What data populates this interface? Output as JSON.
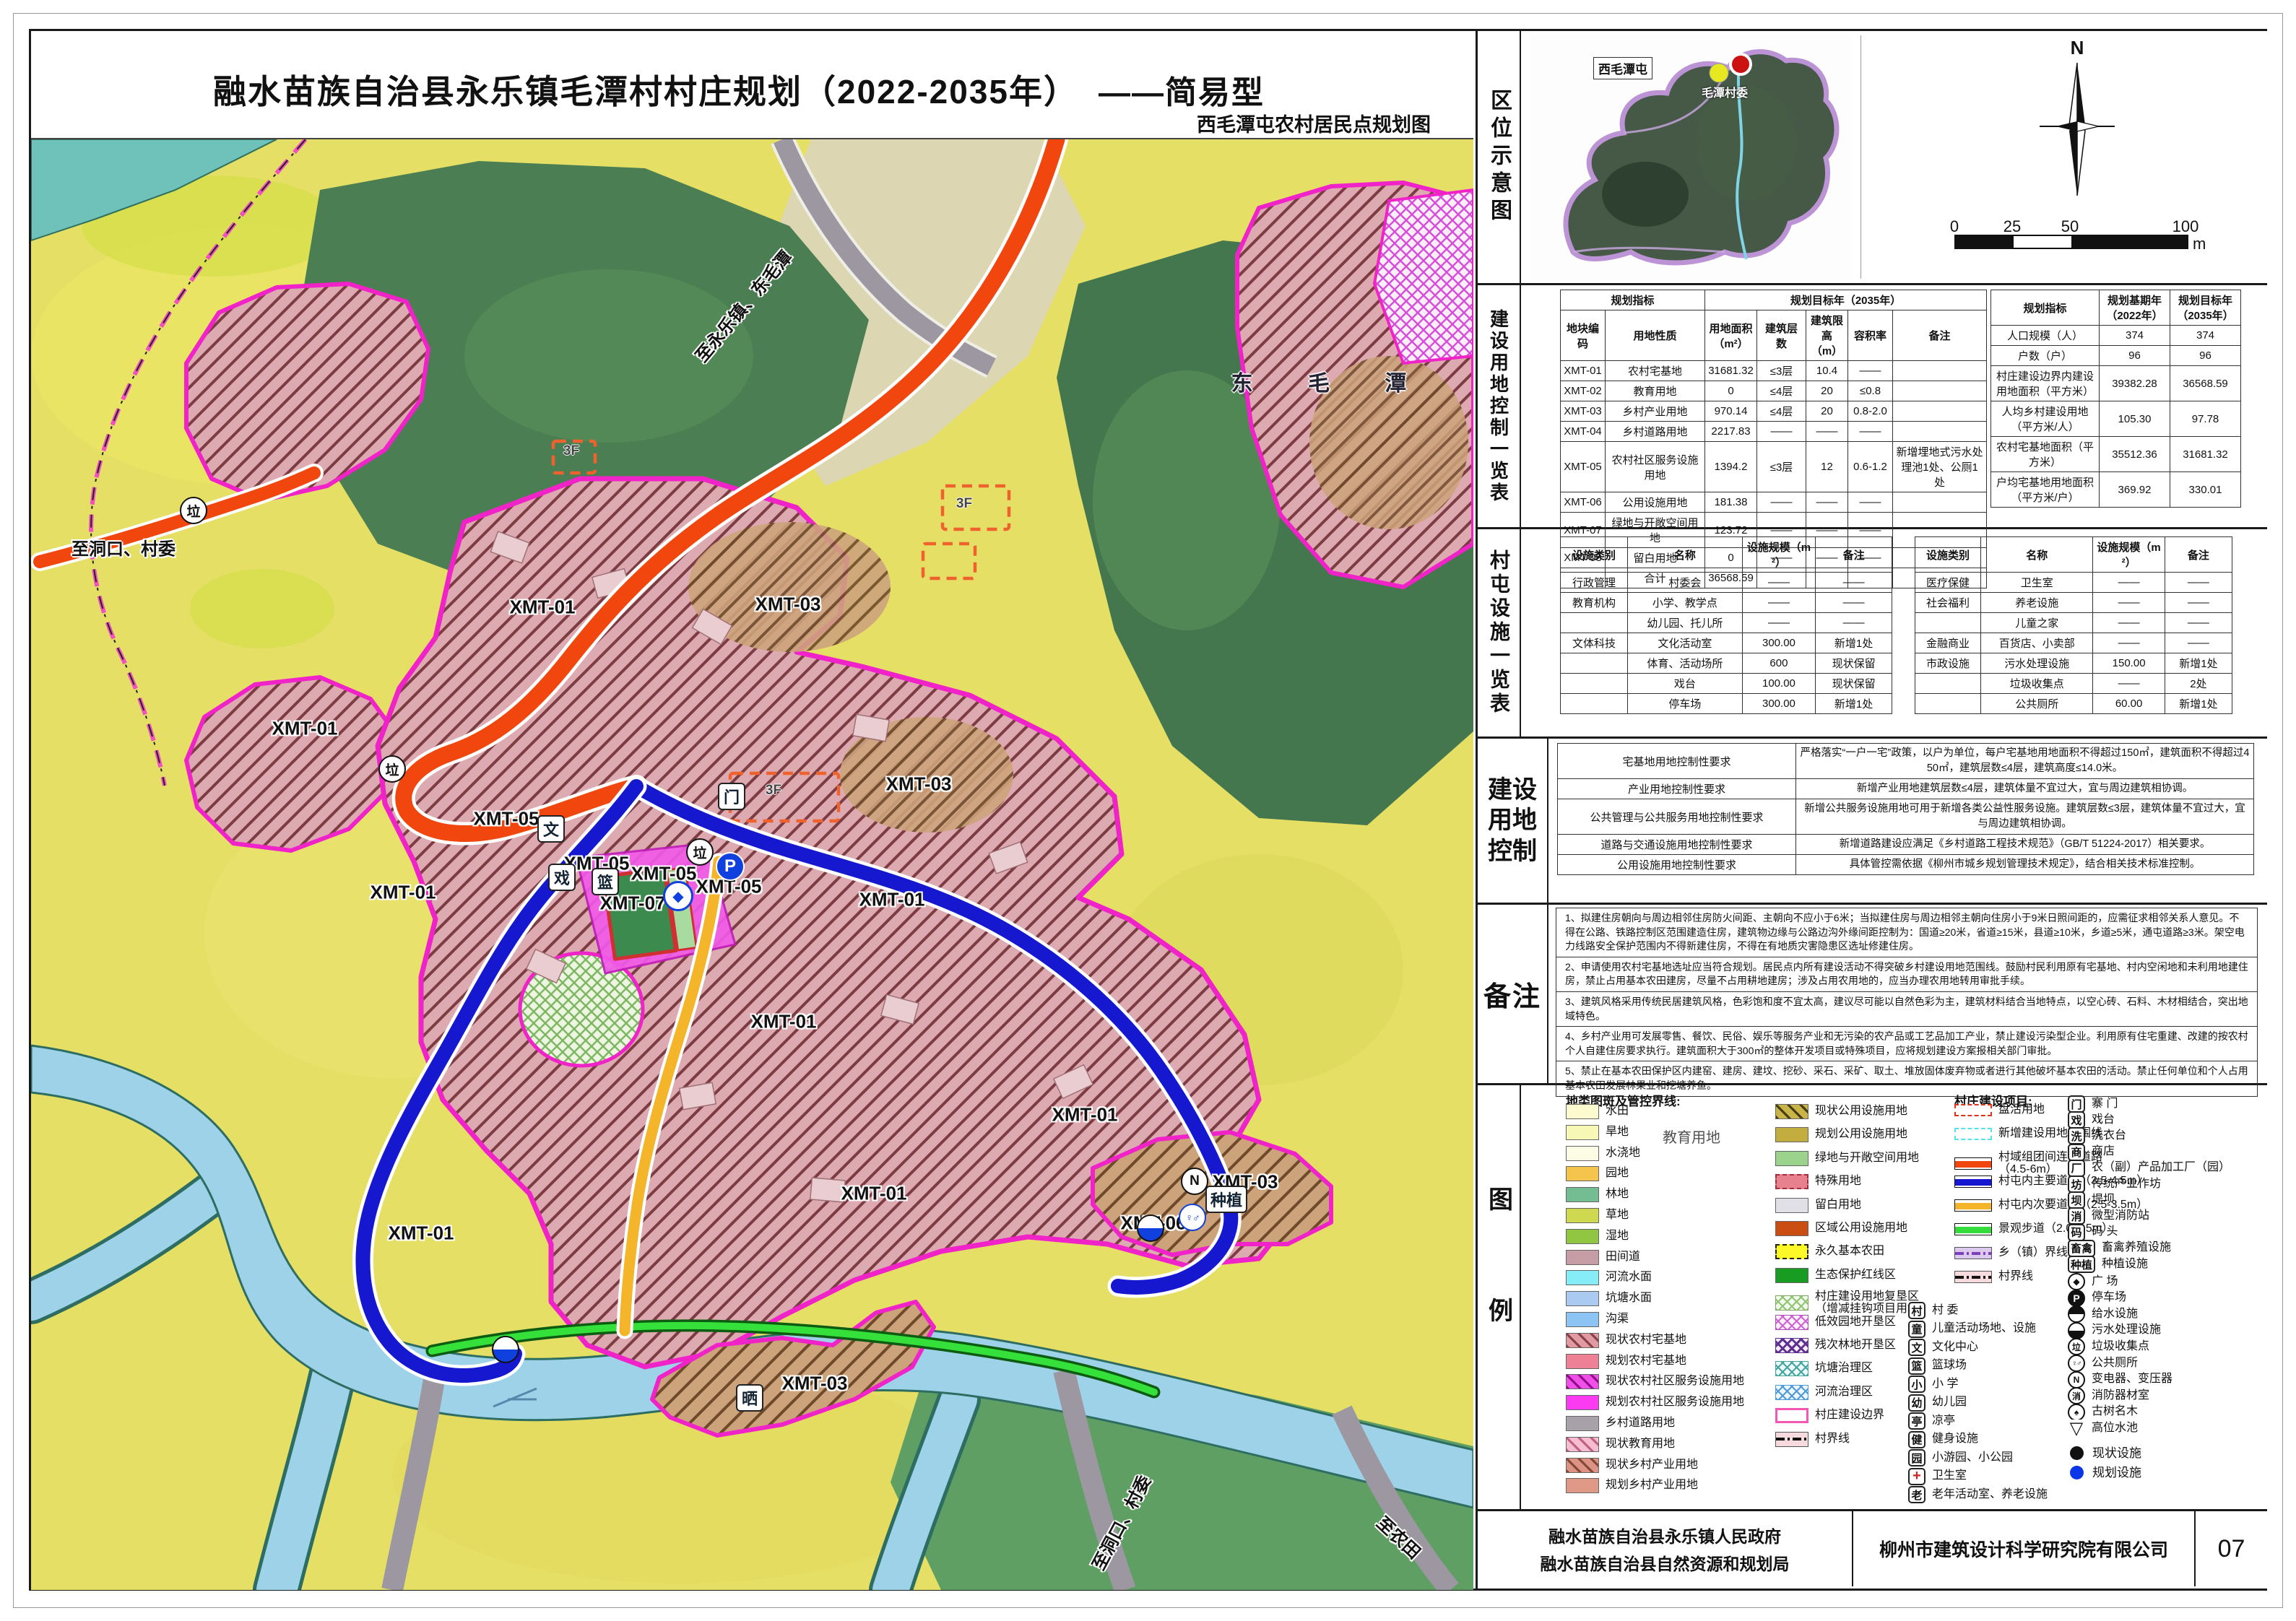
{
  "title": "融水苗族自治县永乐镇毛潭村村庄规划（2022-2035年）",
  "title_suffix": "——简易型",
  "subtitle": "西毛潭屯农村居民点规划图",
  "location": {
    "label": "区位示意图",
    "place_highlight": "西毛潭屯",
    "place_committee": "毛潭村委",
    "north": "N",
    "scale_ticks": [
      "0",
      "25",
      "50",
      "100"
    ],
    "scale_unit": "m"
  },
  "land_table": {
    "label": "建设用地控制一览表",
    "h_plan": "规划指标",
    "h_target": "规划目标年（2035年）",
    "h_code": "地块编码",
    "h_nature": "用地性质",
    "h_area": "用地面积（m²）",
    "h_floors": "建筑层数",
    "h_height": "建筑限高（m）",
    "h_far": "容积率",
    "h_remark": "备注",
    "rows": [
      [
        "XMT-01",
        "农村宅基地",
        "31681.32",
        "≤3层",
        "10.4",
        "——",
        ""
      ],
      [
        "XMT-02",
        "教育用地",
        "0",
        "≤4层",
        "20",
        "≤0.8",
        ""
      ],
      [
        "XMT-03",
        "乡村产业用地",
        "970.14",
        "≤4层",
        "20",
        "0.8-2.0",
        ""
      ],
      [
        "XMT-04",
        "乡村道路用地",
        "2217.83",
        "——",
        "——",
        "——",
        ""
      ],
      [
        "XMT-05",
        "农村社区服务设施用地",
        "1394.2",
        "≤3层",
        "12",
        "0.6-1.2",
        "新增埋地式污水处理池1处、公厕1处"
      ],
      [
        "XMT-06",
        "公用设施用地",
        "181.38",
        "——",
        "——",
        "——",
        ""
      ],
      [
        "XMT-07",
        "绿地与开敞空间用地",
        "123.72",
        "——",
        "——",
        "——",
        ""
      ],
      [
        "XMT-08",
        "留白用地",
        "0",
        "——",
        "——",
        "——",
        ""
      ],
      [
        "",
        "合计",
        "36568.59",
        "",
        "",
        "",
        ""
      ]
    ],
    "ind_h_idx": "规划指标",
    "ind_h_base": "规划基期年（2022年）",
    "ind_h_target": "规划目标年（2035年）",
    "ind_rows": [
      [
        "人口规模（人）",
        "374",
        "374"
      ],
      [
        "户数（户）",
        "96",
        "96"
      ],
      [
        "村庄建设边界内建设用地面积（平方米）",
        "39382.28",
        "36568.59"
      ],
      [
        "人均乡村建设用地（平方米/人）",
        "105.30",
        "97.78"
      ],
      [
        "农村宅基地面积（平方米）",
        "35512.36",
        "31681.32"
      ],
      [
        "户均宅基地用地面积（平方米/户）",
        "369.92",
        "330.01"
      ]
    ]
  },
  "facility_table": {
    "label": "村屯设施一览表",
    "h_cat": "设施类别",
    "h_name": "名称",
    "h_scale": "设施规模（m²）",
    "h_remark": "备注",
    "left_rows": [
      [
        "行政管理",
        "村委会",
        "——",
        "——"
      ],
      [
        "教育机构",
        "小学、教学点",
        "——",
        "——"
      ],
      [
        "",
        "幼儿园、托儿所",
        "——",
        "——"
      ],
      [
        "文体科技",
        "文化活动室",
        "300.00",
        "新增1处"
      ],
      [
        "",
        "体育、活动场所",
        "600",
        "现状保留"
      ],
      [
        "",
        "戏台",
        "100.00",
        "现状保留"
      ],
      [
        "",
        "停车场",
        "300.00",
        "新增1处"
      ]
    ],
    "right_rows": [
      [
        "医疗保健",
        "卫生室",
        "——",
        "——"
      ],
      [
        "社会福利",
        "养老设施",
        "——",
        "——"
      ],
      [
        "",
        "儿童之家",
        "——",
        "——"
      ],
      [
        "金融商业",
        "百货店、小卖部",
        "——",
        "——"
      ],
      [
        "市政设施",
        "污水处理设施",
        "150.00",
        "新增1处"
      ],
      [
        "",
        "垃圾收集点",
        "——",
        "2处"
      ],
      [
        "",
        "公共厕所",
        "60.00",
        "新增1处"
      ]
    ]
  },
  "control": {
    "label": "建设用地控制",
    "rows": [
      {
        "t": "宅基地用地控制性要求",
        "d": "严格落实“一户一宅”政策，以户为单位，每户宅基地用地面积不得超过150㎡，建筑面积不得超过450㎡，建筑层数≤4层，建筑高度≤14.0米。"
      },
      {
        "t": "产业用地控制性要求",
        "d": "新增产业用地建筑层数≤4层，建筑体量不宜过大，宜与周边建筑相协调。"
      },
      {
        "t": "公共管理与公共服务用地控制性要求",
        "d": "新增公共服务设施用地可用于新增各类公益性服务设施。建筑层数≤3层，建筑体量不宜过大，宜与周边建筑相协调。"
      },
      {
        "t": "道路与交通设施用地控制性要求",
        "d": "新增道路建设应满足《乡村道路工程技术规范》（GB/T 51224-2017）相关要求。"
      },
      {
        "t": "公用设施用地控制性要求",
        "d": "具体管控需依据《柳州市城乡规划管理技术规定》，结合相关技术标准控制。"
      }
    ]
  },
  "notes": {
    "label": "备注",
    "items": [
      "1、拟建住房朝向与周边相邻住房防火间距、主朝向不应小于6米；当拟建住房与周边相邻主朝向住房小于9米日照间距的，应需征求相邻关系人意见。不得在公路、铁路控制区范围建造住房，建筑物边缘与公路边沟外缘间距控制为：国道≥20米，省道≥15米，县道≥10米，乡道≥5米，通屯道路≥3米。架空电力线路安全保护范围内不得新建住房，不得在有地质灾害隐患区选址修建住房。",
      "2、申请使用农村宅基地选址应当符合规划。居民点内所有建设活动不得突破乡村建设用地范围线。鼓励村民利用原有宅基地、村内空闲地和未利用地建住房，禁止占用基本农田建房，尽量不占用耕地建房；涉及占用农用地的，应当办理农用地转用审批手续。",
      "3、建筑风格采用传统民居建筑风格，色彩饱和度不宜太高，建议尽可能以自然色彩为主，建筑材料结合当地特点，以空心砖、石料、木材相结合，突出地域特色。",
      "4、乡村产业用可发展零售、餐饮、民俗、娱乐等服务产业和无污染的农产品或工艺品加工产业，禁止建设污染型企业。利用原有住宅重建、改建的按农村个人自建住房要求执行。建筑面积大于300㎡的整体开发项目或特殊项目，应将规划建设方案报相关部门审批。",
      "5、禁止在基本农田保护区内建窑、建房、建坟、挖砂、采石、采矿、取土、堆放固体废弃物或者进行其他破坏基本农田的活动。禁止任何单位和个人占用基本农田发展林果业和挖塘养鱼。"
    ]
  },
  "legend": {
    "label": "图例",
    "group1_title": "地类图斑及管控界线:",
    "group2_title": "村庄建设项目:",
    "stray_label": "教育用地",
    "col1": [
      {
        "t": "水田",
        "sw": "background:#fbfbcf"
      },
      {
        "t": "旱地",
        "sw": "background:#f8f8b6"
      },
      {
        "t": "水浇地",
        "sw": "background:#fdfce4"
      },
      {
        "t": "园地",
        "sw": "background:#f4c44c"
      },
      {
        "t": "林地",
        "sw": "background:#74bd92"
      },
      {
        "t": "草地",
        "sw": "background:#ced94f"
      },
      {
        "t": "湿地",
        "sw": "background:#90c641"
      },
      {
        "t": "田间道",
        "sw": "background:#c69da5"
      },
      {
        "t": "河流水面",
        "sw": "background:#86ecf8"
      },
      {
        "t": "坑塘水面",
        "sw": "background:#abcaf1"
      },
      {
        "t": "沟渠",
        "sw": "background:#8cc5f3"
      },
      {
        "t": "现状农村宅基地",
        "sw": "background:repeating-linear-gradient(45deg,#8a4048 0 3px,#e19aa2 3px 12px)"
      },
      {
        "t": "规划农村宅基地",
        "sw": "background:#ee8195"
      },
      {
        "t": "现状农村社区服务设施用地",
        "sw": "background:repeating-linear-gradient(45deg,#930d8a 0 3px,#f14fe9 3px 12px)"
      },
      {
        "t": "规划农村社区服务设施用地",
        "sw": "background:#fa3bf2"
      },
      {
        "t": "乡村道路用地",
        "sw": "background:#a8a1a9"
      },
      {
        "t": "现状教育用地",
        "sw": "background:repeating-linear-gradient(45deg,#c2607f 0 3px,#f6bccf 3px 12px)"
      },
      {
        "t": "现状乡村产业用地",
        "sw": "background:repeating-linear-gradient(45deg,#84473a 0 3px,#dc9384 3px 12px)"
      },
      {
        "t": "规划乡村产业用地",
        "sw": "background:#e19987"
      }
    ],
    "col2": [
      {
        "t": "现状公用设施用地",
        "sw": "background:repeating-linear-gradient(45deg,#453e12 0 3px,#c9b449 3px 12px)"
      },
      {
        "t": "规划公用设施用地",
        "sw": "background:#c3ad3f"
      },
      {
        "t": "绿地与开敞空间用地",
        "sw": "background:#9bd38d"
      },
      {
        "t": "特殊用地",
        "sw": "background:#e8818e;border:2px dashed #a03040"
      },
      {
        "t": "留白用地",
        "sw": "background:#e1e0e7"
      },
      {
        "t": "区域公用设施用地",
        "sw": "background:#ca4e11"
      },
      {
        "t": "永久基本农田",
        "sw": "background:#fdf827;border:2px dashed #222"
      },
      {
        "t": "生态保护红线区",
        "sw": "background:#189c21"
      },
      {
        "t": "村庄建设用地复垦区\n（增减挂钩项目用地）",
        "sw": "background:repeating-linear-gradient(45deg,#8fc473 0 2px,transparent 2px 9px),repeating-linear-gradient(-45deg,#8fc473 0 2px,transparent 2px 9px),#f4faee;border:1px solid #7aa860"
      },
      {
        "t": "低效园地开垦区",
        "sw": "background:repeating-linear-gradient(45deg,#cf63d4 0 2px,transparent 2px 9px),repeating-linear-gradient(-45deg,#cf63d4 0 2px,transparent 2px 9px),#fdf2fe;border:1px solid #b050b8"
      },
      {
        "t": "残次林地开垦区",
        "sw": "background:repeating-linear-gradient(45deg,#5f2f90 0 3px,transparent 3px 9px),repeating-linear-gradient(-45deg,#5f2f90 0 3px,transparent 3px 9px),#f3ecfa;border:1px solid #5f2f90"
      },
      {
        "t": "坑塘治理区",
        "sw": "background:repeating-linear-gradient(45deg,#44a5a0 0 2px,transparent 2px 9px),repeating-linear-gradient(-45deg,#44a5a0 0 2px,transparent 2px 9px),#eefafa;border:1px solid #44a5a0"
      },
      {
        "t": "河流治理区",
        "sw": "background:repeating-linear-gradient(45deg,#4f9ad9 0 2px,transparent 2px 9px),repeating-linear-gradient(-45deg,#4f9ad9 0 2px,transparent 2px 9px),#eef6fe;border:1px solid #4f9ad9"
      },
      {
        "t": "村庄建设边界",
        "sw": "background:#fff;border:3px solid #f357b5"
      },
      {
        "t": "村界线",
        "sw": "background:repeating-linear-gradient(90deg,#111 0 12px,transparent 12px 16px,#111 16px 19px,transparent 19px 23px) center/100% 4px no-repeat,#f6dade;border:1px solid #555"
      }
    ],
    "col3": [
      {
        "t": "盘活用地",
        "sw": "background:#fff;border:2px dashed #dd3418"
      },
      {
        "t": "新增建设用地范围线",
        "sw": "background:#fff;border:2px dashed #55e2ee"
      },
      {
        "t": "村域组团间连接道路\n（4.5-6m）",
        "sw": "background:linear-gradient(#fff 0 4px,#f1470f 4px 13px,#fff 13px 17px);border:1.5px solid #111"
      },
      {
        "t": "村屯内主要道路（3.5-4.5m）",
        "sw": "background:linear-gradient(#fff 0 4px,#1518cf 4px 13px,#fff 13px 17px);border:1.5px solid #111"
      },
      {
        "t": "村屯内次要道路（2.5-3.5m）",
        "sw": "background:linear-gradient(#fff 0 4px,#f5b52b 4px 13px,#fff 13px 17px);border:1.5px solid #111"
      },
      {
        "t": "景观步道（2.0-2.5m）",
        "sw": "background:linear-gradient(#fff 0 4px,#35dd3c 4px 13px,#fff 13px 17px);border:1.5px solid #111"
      },
      {
        "t": "乡（镇）界线",
        "sw": "background:repeating-linear-gradient(90deg,#7b3fc0 0 12px,transparent 12px 16px,#7b3fc0 16px 19px,transparent 19px 23px) center/100% 4px no-repeat,#dcc9f0;border:1px solid #555"
      },
      {
        "t": "村界线",
        "sw": "background:repeating-linear-gradient(90deg,#111 0 12px,transparent 12px 16px,#111 16px 19px,transparent 19px 23px) center/100% 4px no-repeat,#f6dade;border:1px solid #555"
      }
    ],
    "col3_icons": [
      {
        "g": "村",
        "t": "村  委"
      },
      {
        "g": "童",
        "t": "儿童活动场地、设施"
      },
      {
        "g": "文",
        "t": "文化中心"
      },
      {
        "g": "篮",
        "t": "篮球场"
      },
      {
        "g": "小",
        "t": "小  学"
      },
      {
        "g": "幼",
        "t": "幼儿园"
      },
      {
        "g": "亭",
        "t": "凉亭"
      },
      {
        "g": "健",
        "t": "健身设施"
      },
      {
        "g": "园",
        "t": "小游园、小公园"
      },
      {
        "g": "+",
        "t": "卫生室",
        "cls": "cross"
      },
      {
        "g": "老",
        "t": "老年活动室、养老设施"
      }
    ],
    "col4_icons": [
      {
        "g": "门",
        "t": "寨  门"
      },
      {
        "g": "戏",
        "t": "戏台"
      },
      {
        "g": "洗",
        "t": "洗衣台"
      },
      {
        "g": "商",
        "t": "商店"
      },
      {
        "g": "厂",
        "t": "农（副）产品加工厂（园）"
      },
      {
        "g": "坊",
        "t": "传统产业作坊"
      },
      {
        "g": "坝",
        "t": "堤坝"
      },
      {
        "g": "消",
        "t": "微型消防站"
      },
      {
        "g": "码",
        "t": "码  头"
      },
      {
        "g": "畜禽",
        "t": "畜禽养殖设施"
      },
      {
        "g": "种植",
        "t": "种植设施"
      }
    ],
    "col4_circles": [
      {
        "g": "◆",
        "t": "广  场",
        "cls": "dia"
      },
      {
        "g": "P",
        "t": "停车场",
        "cls": "pd"
      },
      {
        "g": "",
        "t": "给水设施",
        "cls": "ht"
      },
      {
        "g": "",
        "t": "污水处理设施",
        "cls": "hb"
      },
      {
        "g": "垃",
        "t": "垃圾收集点",
        "cls": ""
      },
      {
        "g": "♀♂",
        "t": "公共厕所",
        "cls": "wc"
      },
      {
        "g": "N",
        "t": "变电器、变压器",
        "cls": ""
      },
      {
        "g": "消",
        "t": "消防器材室",
        "cls": ""
      },
      {
        "g": "♠",
        "t": "古树名木",
        "cls": ""
      },
      {
        "g": "▽",
        "t": "高位水池",
        "cls": "tz"
      }
    ],
    "col4_dots": [
      {
        "t": "现状设施",
        "cls": "dotb"
      },
      {
        "t": "规划设施",
        "cls": "dotu"
      }
    ]
  },
  "footer": {
    "org1": "融水苗族自治县永乐镇人民政府",
    "org2": "融水苗族自治县自然资源和规划局",
    "company": "柳州市建筑设计科学研究院有限公司",
    "page": "07"
  },
  "map": {
    "labels": [
      {
        "t": "XMT-01",
        "c": "xl",
        "s": "left:708px;top:648px;transform:translate(-50%,-50%)"
      },
      {
        "t": "XMT-03",
        "c": "xl",
        "s": "left:1048px;top:644px;transform:translate(-50%,-50%)"
      },
      {
        "t": "XMT-01",
        "c": "xl",
        "s": "left:379px;top:816px;transform:translate(-50%,-50%)"
      },
      {
        "t": "XMT-05",
        "c": "xl",
        "s": "left:658px;top:941px;transform:translate(-50%,-50%)"
      },
      {
        "t": "XMT-01",
        "c": "xl",
        "s": "left:515px;top:1043px;transform:translate(-50%,-50%)"
      },
      {
        "t": "XMT-03",
        "c": "xl",
        "s": "left:1229px;top:893px;transform:translate(-50%,-50%)"
      },
      {
        "t": "XMT-05",
        "c": "xl",
        "s": "left:783px;top:1003px;transform:translate(-50%,-50%)"
      },
      {
        "t": "XMT-05",
        "c": "xl",
        "s": "left:876px;top:1017px;transform:translate(-50%,-50%)"
      },
      {
        "t": "XMT-05",
        "c": "xl",
        "s": "left:966px;top:1035px;transform:translate(-50%,-50%)"
      },
      {
        "t": "XMT-07",
        "c": "xl",
        "s": "left:833px;top:1058px;transform:translate(-50%,-50%)"
      },
      {
        "t": "XMT-01",
        "c": "xl",
        "s": "left:1192px;top:1053px;transform:translate(-50%,-50%)"
      },
      {
        "t": "XMT-01",
        "c": "xl",
        "s": "left:1042px;top:1222px;transform:translate(-50%,-50%)"
      },
      {
        "t": "XMT-01",
        "c": "xl",
        "s": "left:1459px;top:1351px;transform:translate(-50%,-50%)"
      },
      {
        "t": "XMT-01",
        "c": "xl",
        "s": "left:1167px;top:1460px;transform:translate(-50%,-50%)"
      },
      {
        "t": "XMT-01",
        "c": "xl",
        "s": "left:540px;top:1515px;transform:translate(-50%,-50%)"
      },
      {
        "t": "XMT-03",
        "c": "xl",
        "s": "left:1681px;top:1444px;transform:translate(-50%,-50%)"
      },
      {
        "t": "XMT-06",
        "c": "xl",
        "s": "left:1554px;top:1501px;transform:translate(-50%,-50%)"
      },
      {
        "t": "XMT-03",
        "c": "xl",
        "s": "left:1085px;top:1723px;transform:translate(-50%,-50%)"
      },
      {
        "t": "东 毛 潭",
        "c": "pl",
        "s": "left:1800px;top:335px;transform:translate(-50%,-50%)"
      },
      {
        "t": "至永乐镇、东毛潭",
        "c": "dl",
        "s": "left:985px;top:230px;transform:translate(-50%,-50%) rotate(-50deg)"
      },
      {
        "t": "至洞口、村委",
        "c": "dl",
        "s": "left:128px;top:565px;transform:translate(-50%,-50%)"
      },
      {
        "t": "至洞口、村委",
        "c": "dl",
        "s": "left:1508px;top:1915px;transform:translate(-50%,-50%) rotate(-62deg)"
      },
      {
        "t": "至农田",
        "c": "dl",
        "s": "left:1895px;top:1935px;transform:translate(-50%,-50%) rotate(43deg)"
      },
      {
        "t": "3F",
        "c": "fl",
        "s": "left:1028px;top:902px;transform:translate(-50%,-50%)"
      },
      {
        "t": "3F",
        "c": "fl",
        "s": "left:748px;top:432px;transform:translate(-50%,-50%)"
      },
      {
        "t": "3F",
        "c": "fl",
        "s": "left:1292px;top:505px;transform:translate(-50%,-50%)"
      }
    ],
    "icons": [
      {
        "g": "文",
        "k": "mi-box",
        "s": "left:720px;top:955px"
      },
      {
        "g": "戏",
        "k": "mi-box",
        "s": "left:735px;top:1022px"
      },
      {
        "g": "篮",
        "k": "mi-box",
        "s": "left:795px;top:1028px"
      },
      {
        "g": "门",
        "k": "mi-box",
        "s": "left:970px;top:910px"
      },
      {
        "g": "晒",
        "k": "mi-box",
        "s": "left:995px;top:1743px"
      },
      {
        "g": "种植",
        "k": "mi-box wide",
        "s": "left:1655px;top:1468px"
      },
      {
        "g": "垃",
        "k": "mi-circ",
        "s": "left:225px;top:514px"
      },
      {
        "g": "垃",
        "k": "mi-circ",
        "s": "left:500px;top:872px"
      },
      {
        "g": "垃",
        "k": "mi-circ",
        "s": "left:926px;top:987px"
      },
      {
        "g": "P",
        "k": "mi-p",
        "s": "left:968px;top:1007px"
      },
      {
        "g": "◆",
        "k": "mi-dia",
        "s": "left:896px;top:1048px"
      },
      {
        "g": "♀♂",
        "k": "mi-wc",
        "s": "left:1608px;top:1493px"
      },
      {
        "g": "N",
        "k": "mi-circ",
        "s": "left:1611px;top:1443px"
      },
      {
        "g": "",
        "k": "mi-half",
        "s": "left:1550px;top:1508px"
      },
      {
        "g": "",
        "k": "mi-half",
        "s": "left:657px;top:1676px"
      }
    ]
  }
}
